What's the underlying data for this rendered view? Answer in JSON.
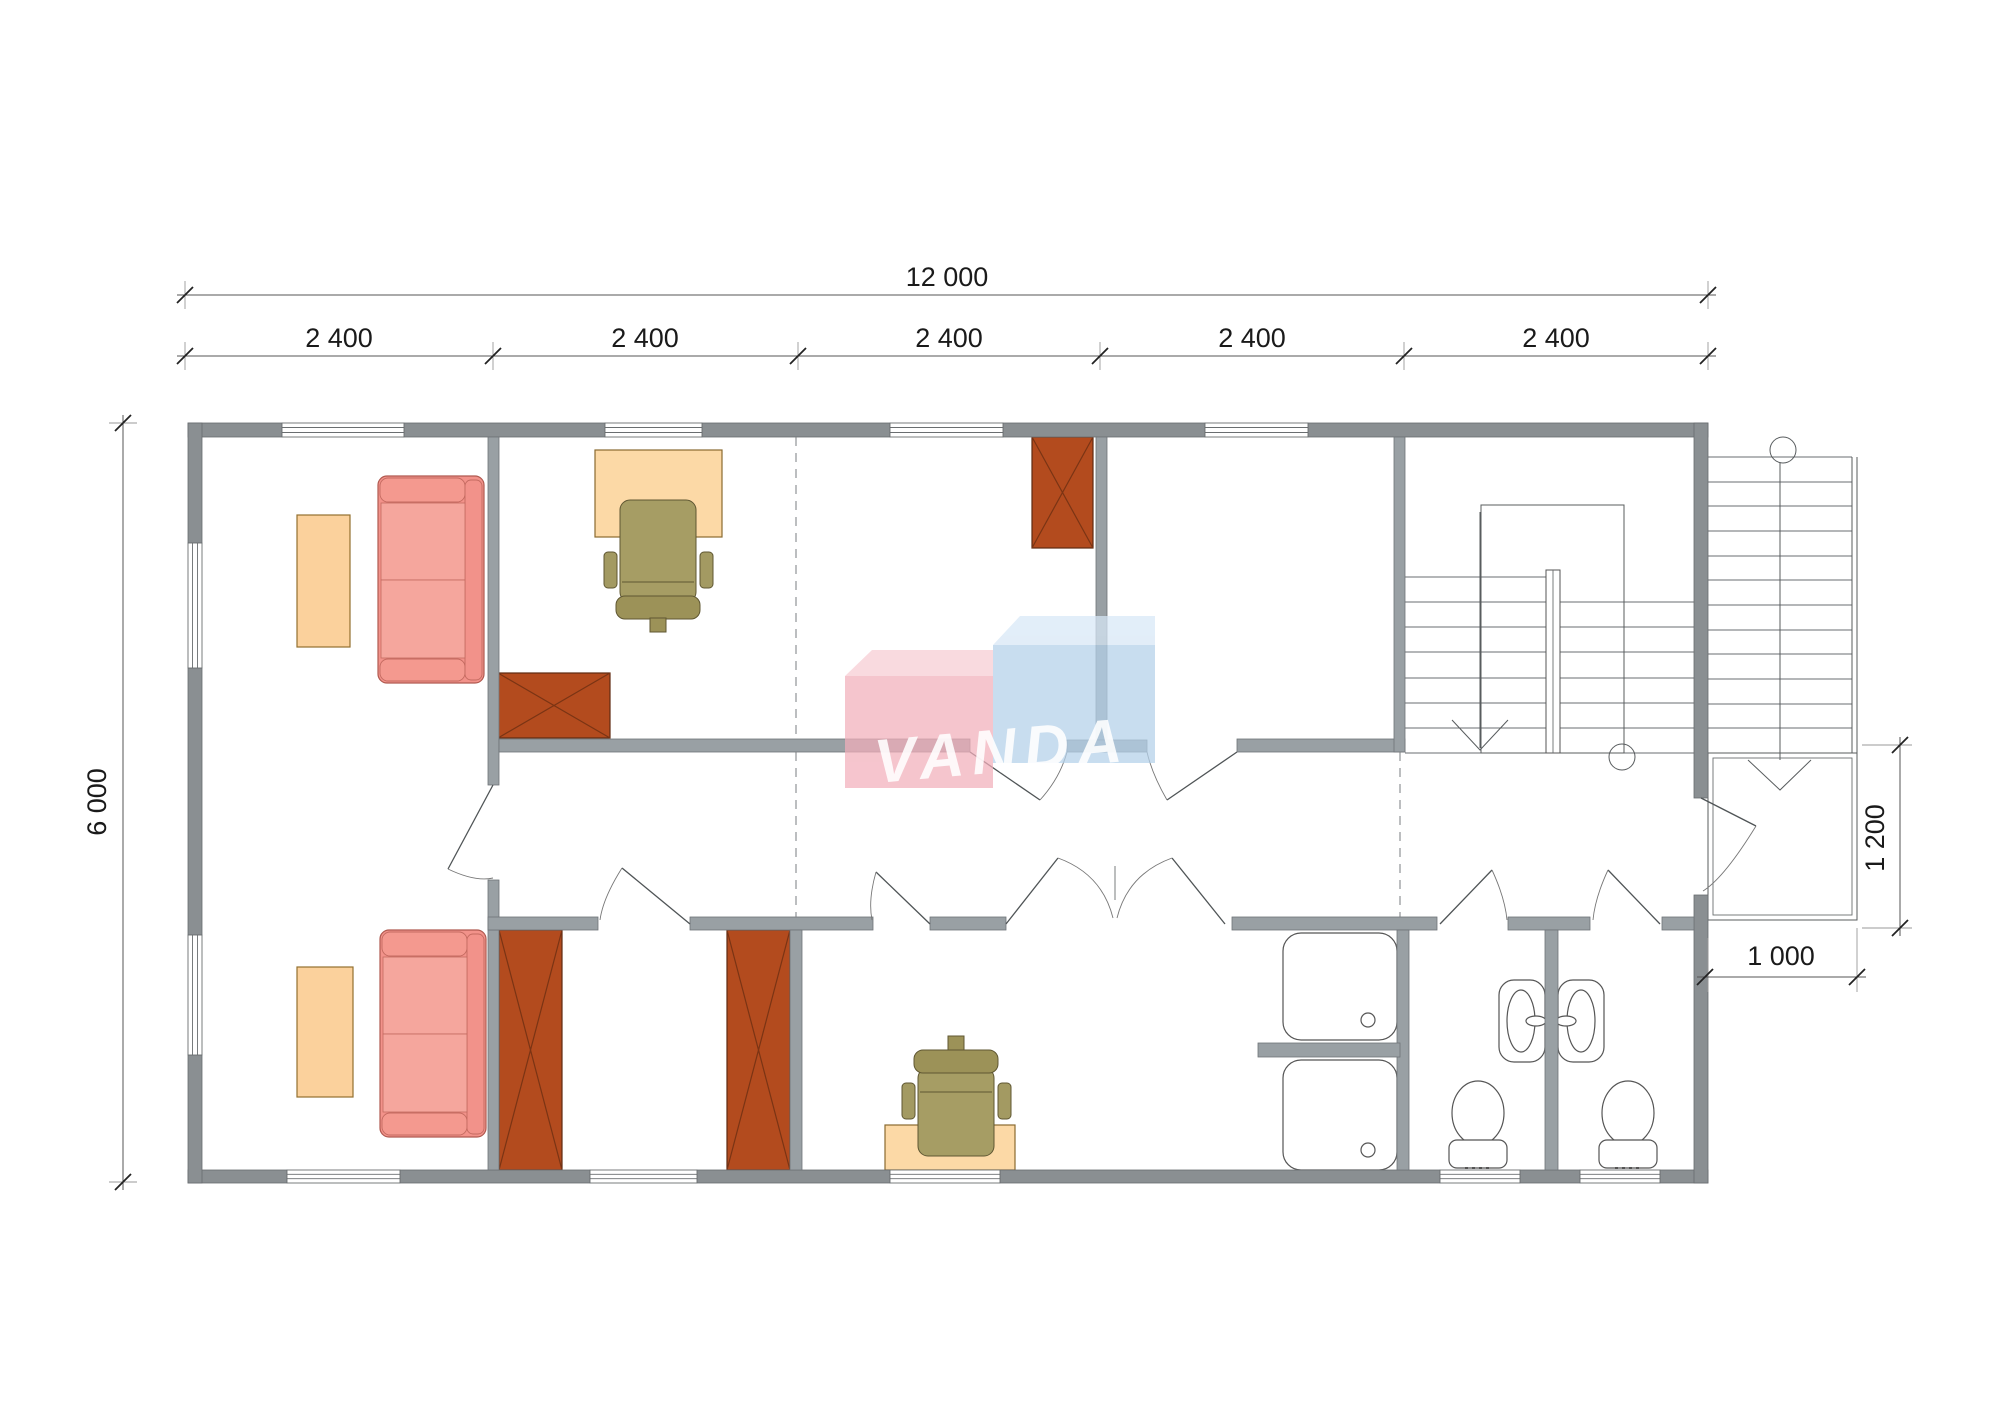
{
  "watermark": {
    "text": "VANDA"
  },
  "dimensions": {
    "overall_width": "12 000",
    "modules": [
      "2 400",
      "2 400",
      "2 400",
      "2 400",
      "2 400"
    ],
    "overall_height": "6 000",
    "entry_landing_depth": "1 200",
    "entry_landing_width": "1 000"
  },
  "colors": {
    "exterior_wall": "#8a8f92",
    "partition_wall": "#99a0a4",
    "sofa": "#f2928a",
    "coffee_table": "#fbd19c",
    "desk": "#fcd9a6",
    "office_chair": "#a69d64",
    "wardrobe": "#b34b1e",
    "watermark_pink": "#f3b6c0",
    "watermark_blue": "#b8d3eb"
  }
}
